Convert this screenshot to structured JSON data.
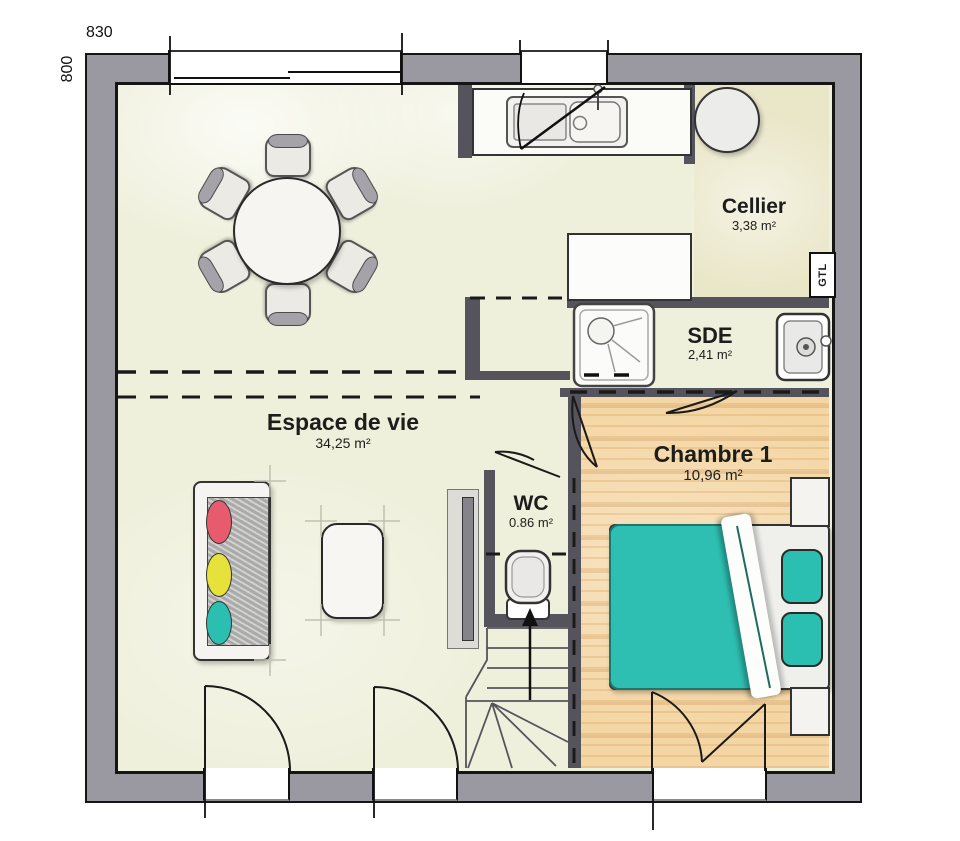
{
  "plan": {
    "title": "floor-plan",
    "dimensions": {
      "width_label": "830",
      "height_label": "800"
    },
    "rooms": [
      {
        "id": "espace_de_vie",
        "name": "Espace de vie",
        "area": "34,25 m²"
      },
      {
        "id": "cellier",
        "name": "Cellier",
        "area": "3,38 m²"
      },
      {
        "id": "sde",
        "name": "SDE",
        "area": "2,41 m²"
      },
      {
        "id": "chambre1",
        "name": "Chambre 1",
        "area": "10,96 m²"
      },
      {
        "id": "wc",
        "name": "WC",
        "area": "0.86 m²"
      }
    ],
    "annotations": {
      "gtl": "GTL"
    },
    "colors": {
      "outer_wall": "#9a99a1",
      "partition": "#55545c",
      "living_floor": "#eff0dc",
      "cellier_floor": "#eae6c8",
      "wood_floor": "#f4d6a4",
      "bed_teal": "#2ebfb2",
      "cushion_red": "#e85a6e",
      "cushion_yellow": "#e7e13c",
      "cushion_teal": "#2abfb0"
    }
  }
}
